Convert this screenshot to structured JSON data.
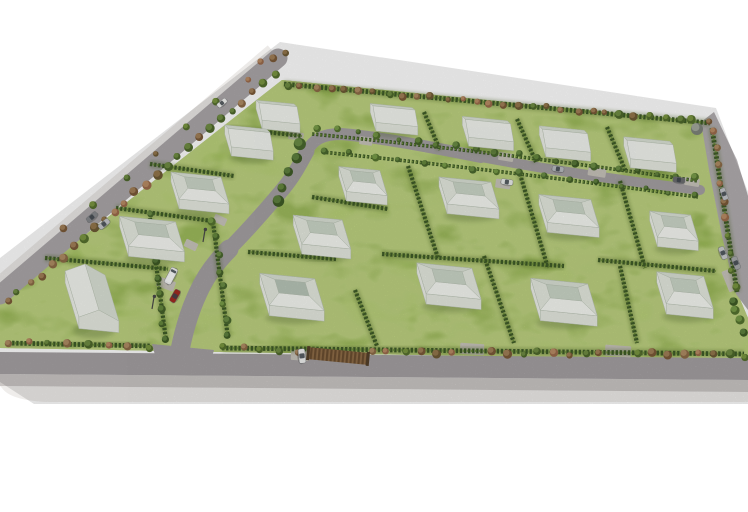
{
  "meta": {
    "width": 748,
    "height": 512,
    "scene_kind": "3d-aerial-site-plan-render"
  },
  "palette": {
    "background": "#ffffff",
    "grass": "#96ba4b",
    "grass_dark": "#618029",
    "grass_light": "#c7dd6b",
    "road": "#a5a1a3",
    "road_light": "#b2aeb0",
    "road_perimeter": "#aba7a9",
    "kerb": "#cbc7c5",
    "slab": "#efedeb",
    "edge_strip": "#eceae8",
    "hedge": "#3f5c28",
    "hedge_shadow": "#46611f",
    "hedge_light": "#70923d",
    "driveway": "#c9c5bc",
    "house_wall_front": "#e7ebe2",
    "house_wall_side": "#eef1ea",
    "house_roof_upper": "#dbe2d6",
    "house_roof_lower": "#f3f5f0",
    "house_roof_top": "#edf0e9",
    "house_roof_facet": "#e6ebe1",
    "house_roof_front": "#f6f8f3",
    "house_plateau": "#ccd7c9",
    "house_plateau_gray": "#b9c6b8",
    "house_stroke": "#b7c1b3",
    "shadow": "#3c5520",
    "glass": "#3e454c",
    "gate_dark": "#6b4e31",
    "gate_light": "#8f6d47",
    "gate_post": "#54402a",
    "lamp": "#4a4a4a",
    "tree_gray": [
      "#7e837a",
      "#a3a89c"
    ]
  },
  "tree_palettes": {
    "autumn": [
      [
        "#7c5a38",
        "#a5835b"
      ],
      [
        "#8d6b47",
        "#b29067"
      ],
      [
        "#56702e",
        "#7e9a44"
      ],
      [
        "#9c6b4c",
        "#bd9068"
      ],
      [
        "#6e5a35",
        "#97794f"
      ],
      [
        "#4e682c",
        "#739046"
      ]
    ],
    "green": [
      [
        "#3f5c26",
        "#628441"
      ],
      [
        "#4a682e",
        "#6f9148"
      ],
      [
        "#55742f",
        "#7da24c"
      ],
      [
        "#46622a",
        "#688c3f"
      ]
    ]
  },
  "site": {
    "outline": [
      [
        282,
        80
      ],
      [
        712,
        122
      ],
      [
        720,
        180
      ],
      [
        730,
        240
      ],
      [
        737,
        292
      ],
      [
        748,
        318
      ],
      [
        748,
        360
      ],
      [
        222,
        352
      ],
      [
        0,
        348
      ],
      [
        0,
        302
      ]
    ]
  },
  "platform": {
    "edge_strip": {
      "x1": 270,
      "y1": 48,
      "x2": -8,
      "y2": 285,
      "w": 7
    },
    "bottom_road": [
      [
        0,
        352
      ],
      [
        748,
        358
      ],
      [
        748,
        380
      ],
      [
        0,
        374
      ]
    ],
    "kerb": [
      [
        0,
        374
      ],
      [
        748,
        380
      ],
      [
        748,
        392
      ],
      [
        0,
        386
      ]
    ],
    "slab_path": "M0,386 L748,392 L748,402 L46,402 Q10,400 2,388 L0,386 Z"
  },
  "roads": {
    "perimeter": {
      "x1": 278,
      "y1": 58,
      "x2": 0,
      "y2": 295,
      "w": 19
    },
    "cul_de_sac": [
      [
        701,
        122
      ],
      [
        714,
        112
      ],
      [
        737,
        160
      ],
      [
        748,
        196
      ],
      [
        748,
        310
      ],
      [
        736,
        294
      ],
      [
        722,
        236
      ],
      [
        709,
        170
      ]
    ],
    "spine": [
      {
        "d": "M178,360 C182,338 188,314 198,293 C205,277 215,263 229,249",
        "w": 19
      },
      {
        "d": "M229,249 C251,227 268,207 283,189 C293,177 299,166 307,151",
        "w": 15
      },
      {
        "d": "M307,151 C313,140 322,134 341,134 C379,137 430,147 481,157",
        "w": 12
      },
      {
        "d": "M481,157 C540,168 600,178 700,190",
        "w": 10
      }
    ],
    "entry_flare": [
      [
        152,
        344
      ],
      [
        214,
        350
      ],
      [
        208,
        370
      ],
      [
        158,
        366
      ]
    ]
  },
  "driveways": [
    [
      296,
      136,
      15,
      8,
      8
    ],
    [
      366,
      141,
      13,
      8,
      8
    ],
    [
      506,
      157,
      15,
      8,
      9
    ],
    [
      597,
      172,
      18,
      9,
      9
    ],
    [
      692,
      182,
      15,
      8,
      9
    ],
    [
      503,
      184,
      15,
      9,
      8
    ],
    [
      220,
      220,
      13,
      8,
      25
    ],
    [
      191,
      245,
      13,
      8,
      25
    ],
    [
      166,
      284,
      18,
      10,
      20
    ],
    [
      472,
      349,
      24,
      11,
      4
    ],
    [
      618,
      351,
      26,
      11,
      4
    ],
    [
      300,
      355,
      18,
      11,
      4
    ],
    [
      731,
      280,
      22,
      12,
      68
    ]
  ],
  "hedges": {
    "dividers": [
      [
        229,
        128,
        302,
        136
      ],
      [
        150,
        164,
        234,
        176
      ],
      [
        116,
        208,
        212,
        221
      ],
      [
        45,
        258,
        168,
        269
      ],
      [
        424,
        112,
        440,
        150
      ],
      [
        517,
        119,
        536,
        162
      ],
      [
        607,
        127,
        626,
        172
      ],
      [
        408,
        166,
        438,
        258
      ],
      [
        520,
        174,
        548,
        268
      ],
      [
        620,
        181,
        645,
        268
      ],
      [
        312,
        197,
        388,
        209
      ],
      [
        248,
        252,
        336,
        259
      ],
      [
        355,
        290,
        377,
        346
      ],
      [
        484,
        256,
        514,
        343
      ],
      [
        620,
        266,
        637,
        343
      ],
      [
        382,
        254,
        564,
        266
      ],
      [
        598,
        260,
        716,
        271
      ],
      [
        150,
        218,
        166,
        340
      ],
      [
        213,
        222,
        228,
        338
      ]
    ],
    "boundaries": [
      [
        284,
        84,
        710,
        123
      ],
      [
        712,
        128,
        737,
        292
      ],
      [
        8,
        343,
        150,
        346
      ],
      [
        222,
        348,
        744,
        354
      ]
    ],
    "spine_paths": [
      "M312,134 Q500,152 698,181",
      "M322,152 Q500,170 698,197"
    ]
  },
  "tree_rows": [
    {
      "x1": 287,
      "y1": 85,
      "x2": 708,
      "y2": 122,
      "n": 30,
      "r1": 2.6,
      "r2": 4.4,
      "pal": "autumn"
    },
    {
      "x1": 274,
      "y1": 75,
      "x2": 8,
      "y2": 302,
      "n": 26,
      "r1": 3,
      "r2": 5,
      "pal": "autumn"
    },
    {
      "x1": 246,
      "y1": 78,
      "x2": 64,
      "y2": 230,
      "n": 7,
      "r1": 2.6,
      "r2": 4,
      "pal": "autumn"
    },
    {
      "x1": 262,
      "y1": 62,
      "x2": 287,
      "y2": 52,
      "n": 3,
      "r1": 3,
      "r2": 4,
      "pal": "autumn"
    },
    {
      "x1": 10,
      "y1": 342,
      "x2": 148,
      "y2": 347,
      "n": 8,
      "r1": 3,
      "r2": 4.5,
      "pal": "autumn"
    },
    {
      "x1": 224,
      "y1": 348,
      "x2": 296,
      "y2": 351,
      "n": 5,
      "r1": 3,
      "r2": 4.5,
      "pal": "autumn"
    },
    {
      "x1": 372,
      "y1": 351,
      "x2": 452,
      "y2": 353,
      "n": 6,
      "r1": 3,
      "r2": 4.5,
      "pal": "autumn"
    },
    {
      "x1": 492,
      "y1": 352,
      "x2": 600,
      "y2": 354,
      "n": 8,
      "r1": 3,
      "r2": 4.8,
      "pal": "autumn"
    },
    {
      "x1": 636,
      "y1": 353,
      "x2": 744,
      "y2": 356,
      "n": 8,
      "r1": 3,
      "r2": 5,
      "pal": "autumn"
    },
    {
      "x1": 713,
      "y1": 132,
      "x2": 735,
      "y2": 288,
      "n": 10,
      "r1": 2.8,
      "r2": 4.2,
      "pal": "autumn"
    },
    {
      "x1": 733,
      "y1": 300,
      "x2": 745,
      "y2": 332,
      "n": 4,
      "r1": 3.5,
      "r2": 5,
      "pal": "green"
    },
    {
      "x1": 318,
      "y1": 128,
      "x2": 696,
      "y2": 178,
      "n": 20,
      "r1": 2.4,
      "r2": 4,
      "pal": "green"
    },
    {
      "x1": 324,
      "y1": 150,
      "x2": 694,
      "y2": 195,
      "n": 16,
      "r1": 2.4,
      "r2": 4,
      "pal": "green"
    },
    {
      "x1": 150,
      "y1": 216,
      "x2": 165,
      "y2": 338,
      "n": 9,
      "r1": 3,
      "r2": 4.6,
      "pal": "green"
    },
    {
      "x1": 214,
      "y1": 222,
      "x2": 228,
      "y2": 336,
      "n": 8,
      "r1": 3,
      "r2": 4.4,
      "pal": "green"
    },
    {
      "x1": 302,
      "y1": 146,
      "x2": 278,
      "y2": 200,
      "n": 5,
      "r1": 4.5,
      "r2": 6.5,
      "pal": "green"
    }
  ],
  "special_trees": [
    {
      "x": 697,
      "y": 129,
      "r": 6
    }
  ],
  "houses": [
    {
      "x": 278,
      "y": 112,
      "w": 38,
      "d": 20,
      "type": "gable",
      "o": "u"
    },
    {
      "x": 249,
      "y": 138,
      "w": 42,
      "d": 22,
      "type": "gable",
      "o": "u"
    },
    {
      "x": 394,
      "y": 115,
      "w": 42,
      "d": 19,
      "type": "gable",
      "o": "u"
    },
    {
      "x": 488,
      "y": 129,
      "w": 45,
      "d": 21,
      "type": "gable",
      "o": "u"
    },
    {
      "x": 565,
      "y": 139,
      "w": 45,
      "d": 22,
      "type": "gable",
      "o": "u"
    },
    {
      "x": 650,
      "y": 150,
      "w": 46,
      "d": 22,
      "type": "gable",
      "o": "u"
    },
    {
      "x": 92,
      "y": 296,
      "w": 40,
      "d": 46,
      "type": "gable",
      "o": "v"
    },
    {
      "x": 200,
      "y": 188,
      "w": 50,
      "d": 27,
      "type": "hip"
    },
    {
      "x": 152,
      "y": 234,
      "w": 56,
      "d": 30,
      "type": "hip"
    },
    {
      "x": 363,
      "y": 181,
      "w": 41,
      "d": 25,
      "type": "hip"
    },
    {
      "x": 469,
      "y": 193,
      "w": 52,
      "d": 27,
      "type": "hip"
    },
    {
      "x": 569,
      "y": 211,
      "w": 52,
      "d": 28,
      "type": "hip"
    },
    {
      "x": 674,
      "y": 226,
      "w": 41,
      "d": 26,
      "type": "hip"
    },
    {
      "x": 322,
      "y": 232,
      "w": 49,
      "d": 29,
      "type": "hip"
    },
    {
      "x": 292,
      "y": 292,
      "w": 55,
      "d": 32,
      "type": "hip",
      "gray": true
    },
    {
      "x": 449,
      "y": 281,
      "w": 55,
      "d": 31,
      "type": "hip"
    },
    {
      "x": 564,
      "y": 297,
      "w": 57,
      "d": 32,
      "type": "hip"
    },
    {
      "x": 685,
      "y": 290,
      "w": 47,
      "d": 32,
      "type": "hip"
    }
  ],
  "vehicles": [
    {
      "x": 222,
      "y": 103,
      "rot": -40,
      "color": "#f4f4f2",
      "kind": "car"
    },
    {
      "x": 92,
      "y": 217,
      "rot": -40,
      "color": "#87898d",
      "kind": "car"
    },
    {
      "x": 104,
      "y": 224,
      "rot": -40,
      "color": "#c7c8cb",
      "kind": "car"
    },
    {
      "x": 171,
      "y": 276,
      "rot": -62,
      "color": "#f2f3f1",
      "kind": "van"
    },
    {
      "x": 175,
      "y": 296,
      "rot": -60,
      "color": "#a32b21",
      "kind": "car"
    },
    {
      "x": 558,
      "y": 169,
      "rot": 8,
      "color": "#babdc1",
      "kind": "car"
    },
    {
      "x": 507,
      "y": 182,
      "rot": 8,
      "color": "#eceeec",
      "kind": "car"
    },
    {
      "x": 679,
      "y": 180,
      "rot": 8,
      "color": "#6b6d70",
      "kind": "car"
    },
    {
      "x": 724,
      "y": 194,
      "rot": 70,
      "color": "#c2c5c9",
      "kind": "car"
    },
    {
      "x": 723,
      "y": 253,
      "rot": 68,
      "color": "#cbcdcf",
      "kind": "car"
    },
    {
      "x": 736,
      "y": 263,
      "rot": 68,
      "color": "#a8aaac",
      "kind": "car"
    },
    {
      "x": 302,
      "y": 356,
      "rot": 84,
      "color": "#f1f2f0",
      "kind": "car"
    }
  ],
  "gate": {
    "x": 338,
    "y": 356,
    "w": 60,
    "h": 12,
    "rot": 5.5
  },
  "lamps": [
    [
      203,
      242
    ],
    [
      152,
      309
    ]
  ],
  "grain_clip": [
    [
      280,
      42
    ],
    [
      716,
      108
    ],
    [
      748,
      192
    ],
    [
      748,
      404
    ],
    [
      34,
      404
    ],
    [
      0,
      382
    ],
    [
      0,
      258
    ]
  ],
  "counts": {
    "plots": 18,
    "houses": 18,
    "vehicles": 12
  }
}
